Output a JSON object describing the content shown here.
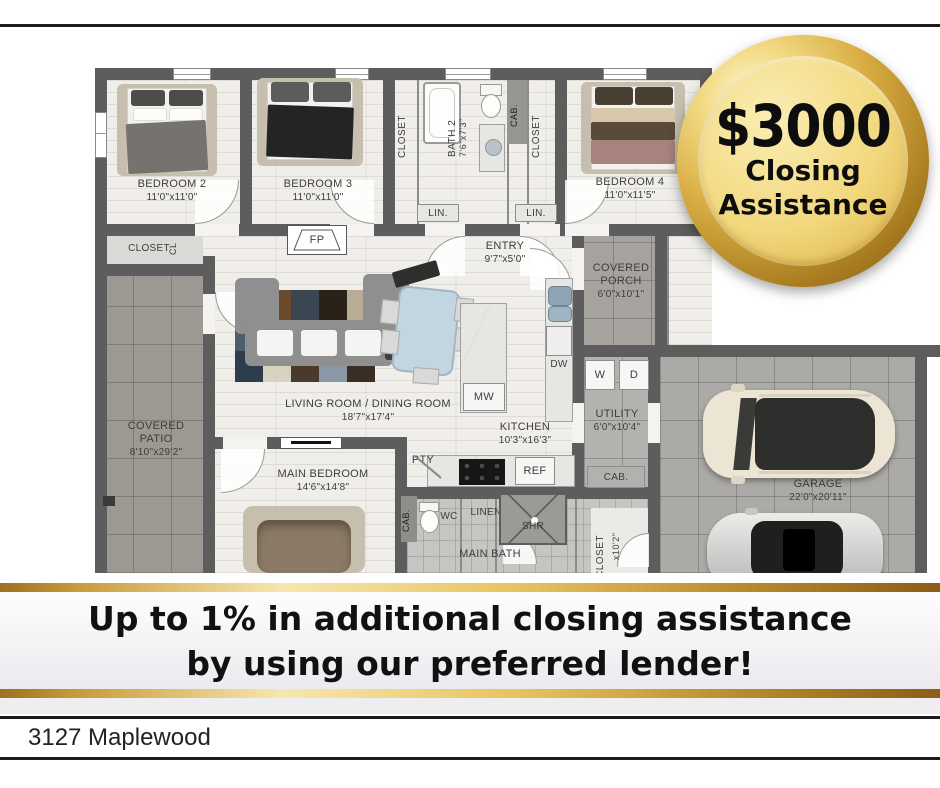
{
  "badge": {
    "amount": "$3000",
    "line1": "Closing",
    "line2": "Assistance"
  },
  "banner": {
    "line1": "Up to 1% in additional closing assistance",
    "line2": "by using our preferred lender!"
  },
  "address": "3127 Maplewood",
  "colors": {
    "gold_dark": "#8a5f16",
    "gold_light": "#f7e7ae",
    "wall": "#5d5d5d"
  },
  "floorplan": {
    "rooms": {
      "bedroom2": {
        "name": "BEDROOM 2",
        "dims": "11'0\"x11'0\""
      },
      "bedroom3": {
        "name": "BEDROOM 3",
        "dims": "11'0\"x11'0\""
      },
      "bedroom4": {
        "name": "BEDROOM 4",
        "dims": "11'0\"x11'5\""
      },
      "bath2": {
        "name": "BATH 2",
        "dims": "7'6\"x7'3\""
      },
      "entry": {
        "name": "ENTRY",
        "dims": "9'7\"x5'0\""
      },
      "porch": {
        "name": "COVERED PORCH",
        "dims": "6'0\"x10'1\""
      },
      "living": {
        "name": "LIVING ROOM / DINING ROOM",
        "dims": "18'7\"x17'4\""
      },
      "kitchen": {
        "name": "KITCHEN",
        "dims": "10'3\"x16'3\""
      },
      "utility": {
        "name": "UTILITY",
        "dims": "6'0\"x10'4\""
      },
      "patio": {
        "name": "COVERED PATIO",
        "dims": "8'10\"x29'2\""
      },
      "main_bedroom": {
        "name": "MAIN BEDROOM",
        "dims": "14'6\"x14'8\""
      },
      "garage": {
        "name": "GARAGE",
        "dims": "22'0\"x20'11\""
      },
      "main_bath": {
        "name": "MAIN BATH"
      },
      "main_closet": {
        "name": "CLOSET",
        "dims": "x10'2\""
      }
    },
    "fixtures": {
      "fp": "FP",
      "mw": "MW",
      "dw": "DW",
      "w": "W",
      "d": "D",
      "pty": "PTY",
      "ref": "REF",
      "wc": "WC",
      "shr": "SHR",
      "linen": "LINEN",
      "lin1": "LIN.",
      "lin2": "LIN.",
      "cab_top": "CAB.",
      "cab_utility": "CAB.",
      "cab_bath": "CAB.",
      "closet_top_left": "CLOSET",
      "closet_top_right": "CLOSET",
      "closet_corner": "CLOSET",
      "cl": "CL"
    }
  }
}
